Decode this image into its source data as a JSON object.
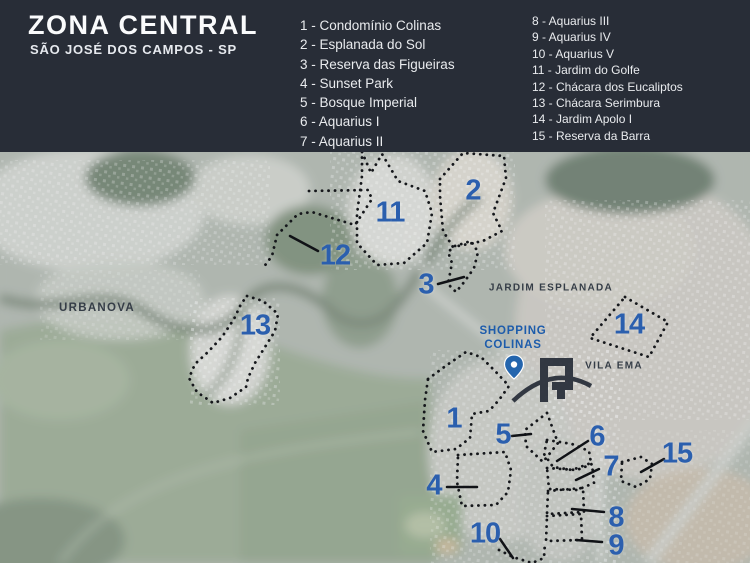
{
  "header": {
    "title": "ZONA CENTRAL",
    "subtitle": "SÃO JOSÉ DOS CAMPOS - SP",
    "legend_columns": [
      {
        "items": [
          {
            "label": "1 - Condomínio Colinas"
          },
          {
            "label": "2 - Esplanada do Sol"
          },
          {
            "label": "3 - Reserva das Figueiras"
          },
          {
            "label": "4 - Sunset Park"
          },
          {
            "label": "5 - Bosque Imperial"
          },
          {
            "label": "6 - Aquarius I"
          },
          {
            "label": "7 - Aquarius II"
          }
        ]
      },
      {
        "items": [
          {
            "label": "8 - Aquarius III"
          },
          {
            "label": "9 - Aquarius IV"
          },
          {
            "label": "10 - Aquarius V"
          },
          {
            "label": "11 - Jardim do Golfe"
          },
          {
            "label": "12 - Chácara dos Eucaliptos"
          },
          {
            "label": "13 - Chácara Serimbura"
          },
          {
            "label": "14 - Jardim Apolo I"
          },
          {
            "label": "15 - Reserva da Barra"
          }
        ]
      }
    ]
  },
  "map": {
    "area_labels": [
      {
        "text": "URBANOVA",
        "x": 97,
        "y": 308,
        "size": 11.5
      },
      {
        "text": "JARDIM ESPLANADA",
        "x": 551,
        "y": 288,
        "size": 10
      },
      {
        "text": "VILA EMA",
        "x": 614,
        "y": 366,
        "size": 10
      }
    ],
    "poi": {
      "name": "SHOPPING COLINAS",
      "lines": [
        "SHOPPING",
        "COLINAS"
      ]
    },
    "markers": [
      {
        "num": "1",
        "x": 454,
        "y": 419
      },
      {
        "num": "2",
        "x": 473,
        "y": 191
      },
      {
        "num": "3",
        "x": 426,
        "y": 285
      },
      {
        "num": "4",
        "x": 434,
        "y": 486
      },
      {
        "num": "5",
        "x": 503,
        "y": 435
      },
      {
        "num": "6",
        "x": 597,
        "y": 437
      },
      {
        "num": "7",
        "x": 611,
        "y": 467
      },
      {
        "num": "8",
        "x": 616,
        "y": 518
      },
      {
        "num": "9",
        "x": 616,
        "y": 546
      },
      {
        "num": "10",
        "x": 485,
        "y": 534
      },
      {
        "num": "11",
        "x": 390,
        "y": 213
      },
      {
        "num": "12",
        "x": 335,
        "y": 256
      },
      {
        "num": "13",
        "x": 255,
        "y": 326
      },
      {
        "num": "14",
        "x": 629,
        "y": 325
      },
      {
        "num": "15",
        "x": 677,
        "y": 454
      }
    ]
  },
  "colors": {
    "header_bg": "#282d37",
    "marker_blue": "#2b5fae",
    "poi_blue": "#1d5cab",
    "area_label_dark": "#353d47",
    "outline_black": "#15171b"
  }
}
